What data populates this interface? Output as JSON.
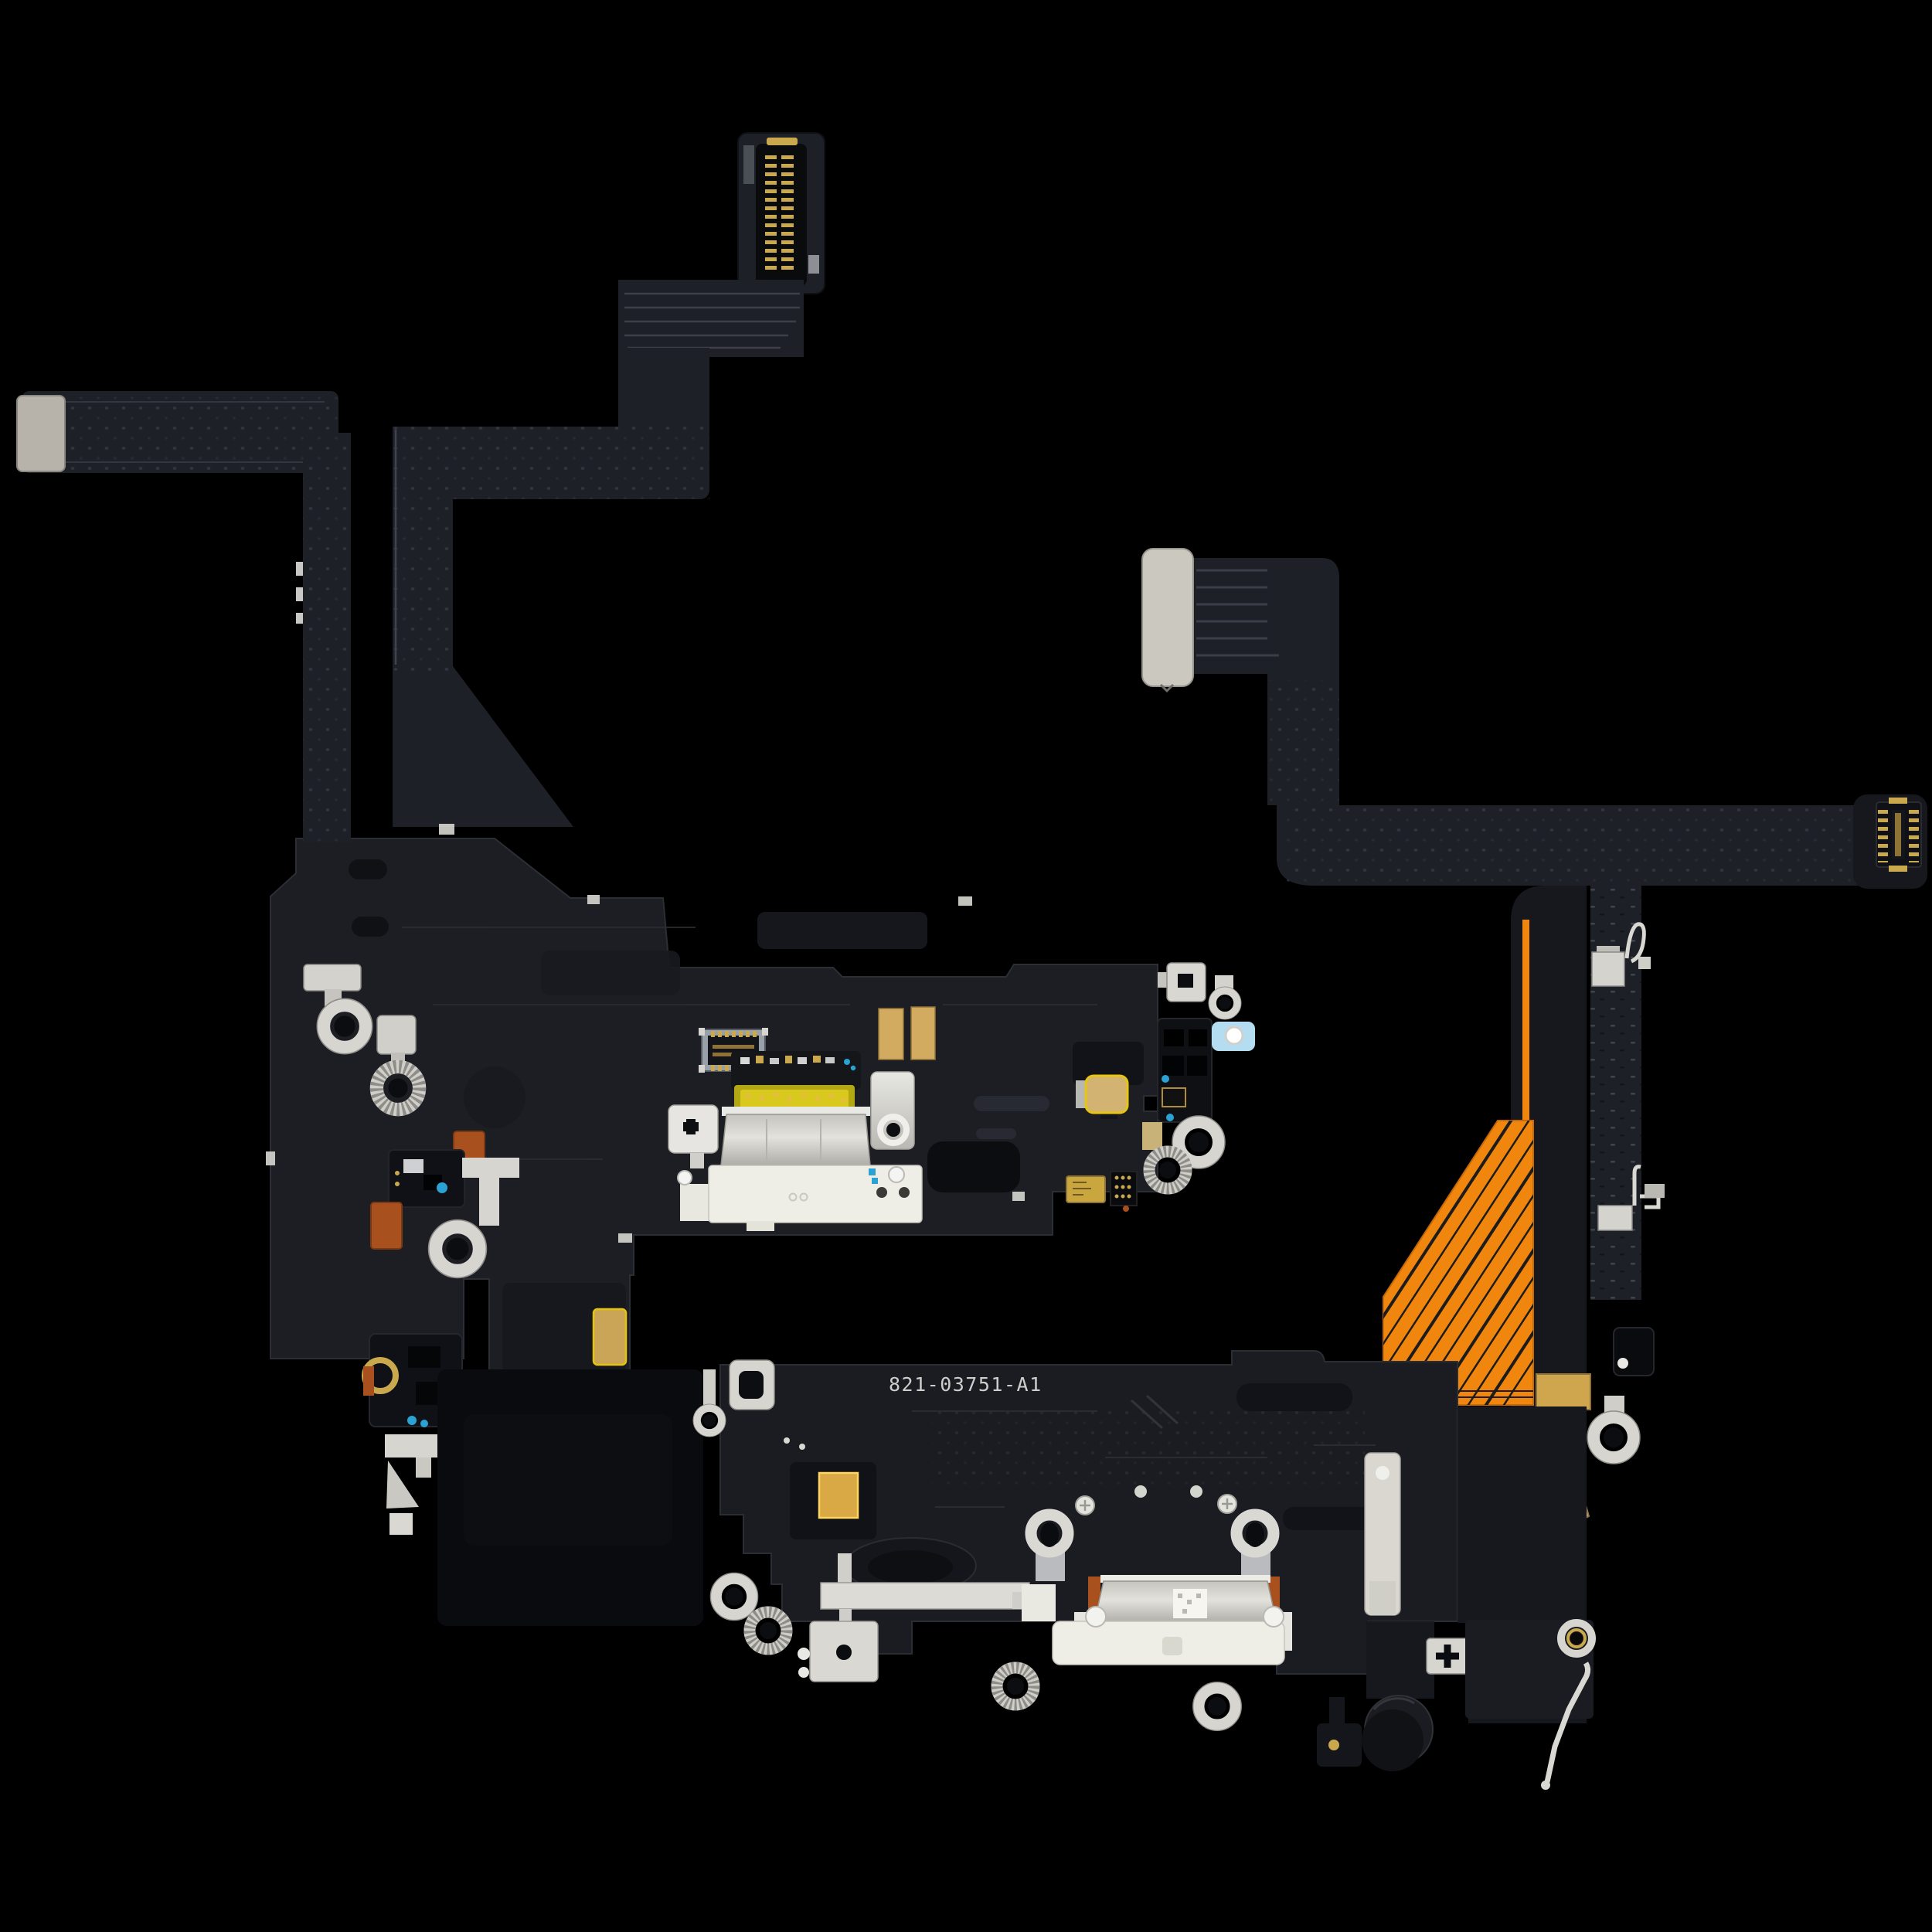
{
  "photo": {
    "part_number": "821-03751-A1",
    "subject": "charging-port-flex-cable-two-views"
  },
  "colors": {
    "background": "#000000",
    "flex_ribbon_dark": "#1e2027",
    "board_dark": "#1d1e24",
    "board_dark_2": "#1b1c22",
    "recess_dark": "#101116",
    "stiffener_gray": "#cbc8c0",
    "stiffener_gray_2": "#b7b3ab",
    "metal_silver": "#d6d5d0",
    "metal_silver_bright": "#e9e8e4",
    "plastic_white": "#efeee6",
    "shell_silver": "#c9c8c2",
    "gold_pad": "#d2ab61",
    "gold_pin": "#caa84e",
    "kapton_yellow": "#d9c81e",
    "kapton_olive": "#b3a713",
    "orange_flex": "#f1860f",
    "orange_solder": "#a8511f",
    "woven_gold": "#c7ae82",
    "blue_tape": "#b5ddf1",
    "blue_component": "#2aa2d4",
    "text_white": "#dededb"
  }
}
